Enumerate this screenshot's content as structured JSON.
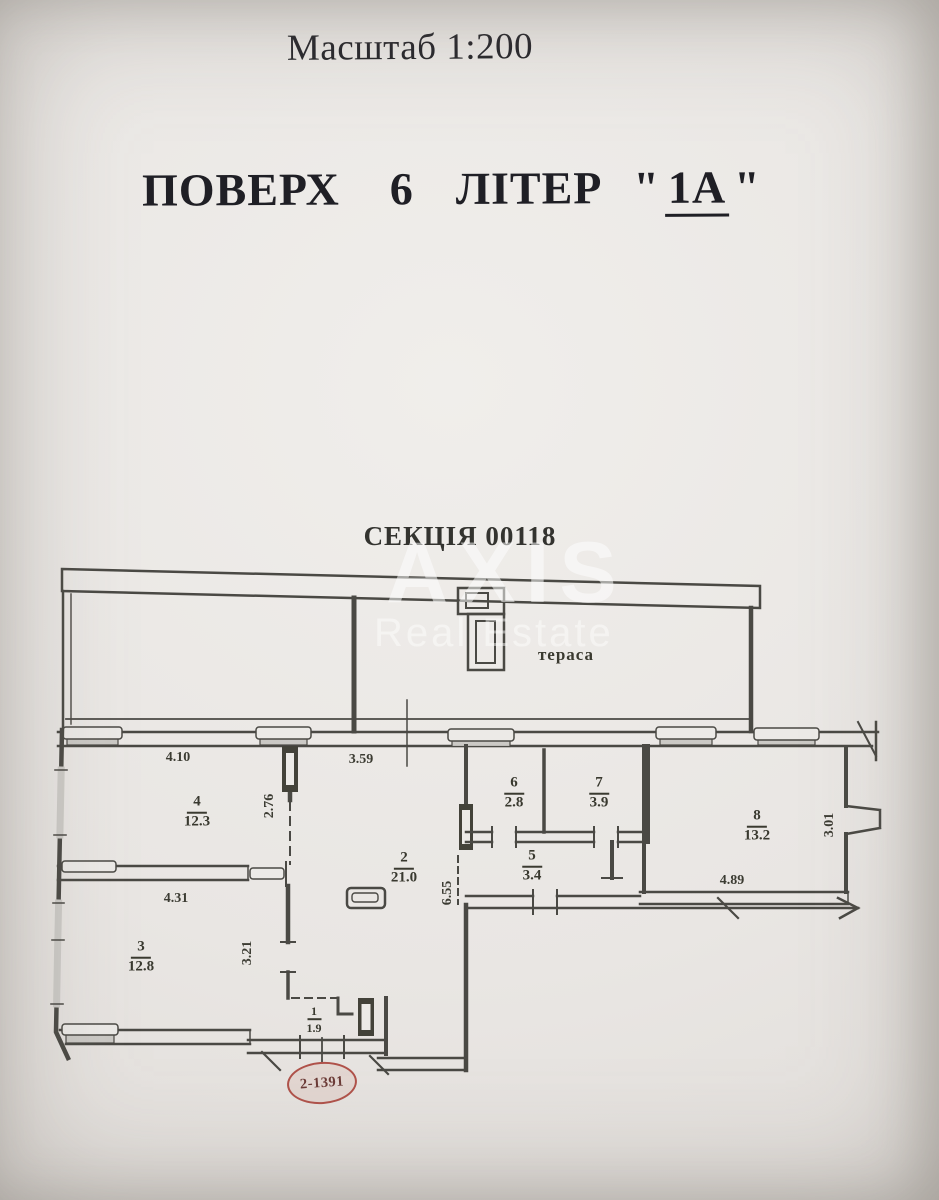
{
  "page": {
    "background": "#e9e6e3",
    "ink": "#4a4944",
    "accent_red": "#b0524a"
  },
  "header": {
    "scale_label": "Масштаб 1:200",
    "floor_word": "ПОВЕРХ",
    "floor_number": "6",
    "letter_word": "ЛІТЕР",
    "open_quote": "\"",
    "letter_value": "1А",
    "close_quote": "\""
  },
  "section": {
    "label": "СЕКЦІЯ 00118"
  },
  "watermark": {
    "brand": "AXIS",
    "subtitle": "Real Estate"
  },
  "plan": {
    "terrace_label": "тераса",
    "apartment_tag": "2-1391",
    "rooms": [
      {
        "number": "1",
        "area": "1.9"
      },
      {
        "number": "2",
        "area": "21.0"
      },
      {
        "number": "3",
        "area": "12.8"
      },
      {
        "number": "4",
        "area": "12.3"
      },
      {
        "number": "5",
        "area": "3.4"
      },
      {
        "number": "6",
        "area": "2.8"
      },
      {
        "number": "7",
        "area": "3.9"
      },
      {
        "number": "8",
        "area": "13.2"
      }
    ],
    "dimensions": {
      "d410": "4.10",
      "d359": "3.59",
      "d276": "2.76",
      "d431": "4.31",
      "d321": "3.21",
      "d655": "6.55",
      "d489": "4.89",
      "d301": "3.01"
    }
  }
}
